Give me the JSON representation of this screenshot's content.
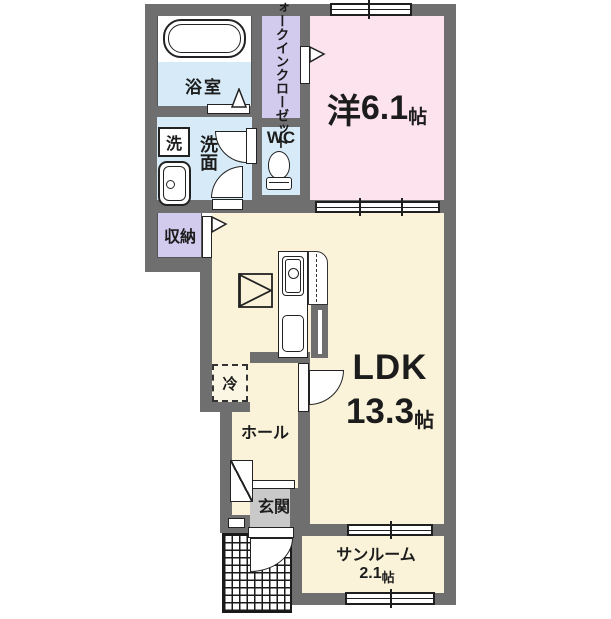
{
  "plan_type": "apartment-floor-plan",
  "colors": {
    "wall": "#6f6f6f",
    "wet_area_blue": "#d6ebf7",
    "closet_lavender": "#d2cbee",
    "bedroom_pink": "#fce3ee",
    "living_cream": "#faf3da",
    "entrance_gray": "#c9c9c9"
  },
  "rooms": {
    "bath": {
      "label": "浴室"
    },
    "washer": {
      "label": "洗"
    },
    "washroom": {
      "label": "洗面"
    },
    "wc": {
      "label": "WC"
    },
    "wic": {
      "line1": "ウォークイン",
      "line2": "クローゼット"
    },
    "western": {
      "name": "洋",
      "size": "6.1",
      "unit": "帖"
    },
    "storage": {
      "label": "収納"
    },
    "fridge": {
      "label": "冷"
    },
    "ldk": {
      "name": "LDK",
      "size": "13.3",
      "unit": "帖"
    },
    "hall": {
      "label": "ホール"
    },
    "entrance": {
      "label": "玄関"
    },
    "sunroom": {
      "name": "サンルーム",
      "size": "2.1",
      "unit": "帖"
    }
  }
}
